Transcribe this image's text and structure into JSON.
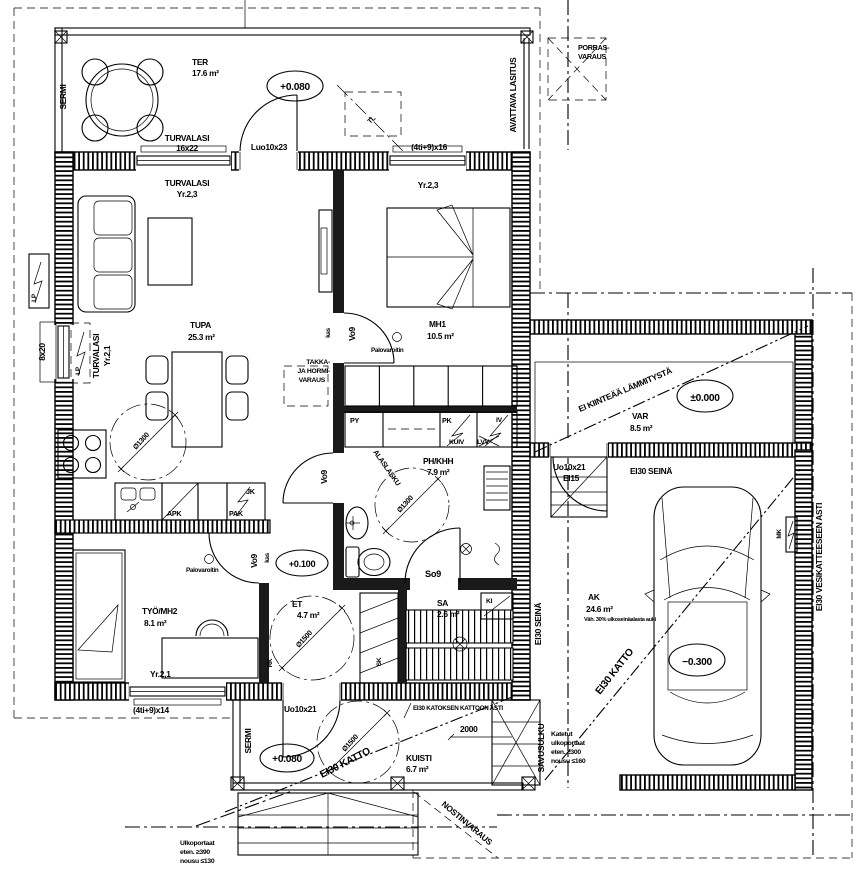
{
  "rooms": {
    "ter": {
      "name": "TER",
      "area": "17.6 m²"
    },
    "tupa": {
      "name": "TUPA",
      "area": "25.3 m²"
    },
    "mh1": {
      "name": "MH1",
      "area": "10.5 m²"
    },
    "ph_khh": {
      "name": "PH/KHH",
      "area": "7.9 m²"
    },
    "tyo_mh2": {
      "name": "TYÖ/MH2",
      "area": "8.1 m²"
    },
    "et": {
      "name": "ET",
      "area": "4.7 m²"
    },
    "sa": {
      "name": "SA",
      "area": "2.6 m²"
    },
    "var": {
      "name": "VAR",
      "area": "8.5 m²"
    },
    "ak": {
      "name": "AK",
      "area": "24.6 m²",
      "note": "Väh. 30% ulkoseinäalasta auki"
    },
    "kuisti": {
      "name": "KUISTI",
      "area": "6.7 m²"
    }
  },
  "levels": {
    "terrace": "+0.080",
    "porch": "+0.080",
    "entry": "+0.100",
    "storage": "±0.000",
    "carport": "−0.300"
  },
  "openings": {
    "turvalasi": "TURVALASI",
    "w16x22": "16x22",
    "luo10x23": "Luo10x23",
    "w4ti9x16": "(4ti+9)x16",
    "yr23": "Yr.2,3",
    "w8x20": "8x20",
    "yr21": "Yr.2,1",
    "w4ti9x14": "(4ti+9)x14",
    "uo10x21": "Uo10x21",
    "ei15": "EI15",
    "vo9": "Vo9",
    "so9": "So9",
    "kas": "kas"
  },
  "annotations": {
    "sermi": "SERMI",
    "avattava": "AVATTAVA LASITUS",
    "porras1": "PORRAS-",
    "porras2": "VARAUS",
    "tl": "TL",
    "palovaroitin": "Palovaroitin",
    "takka1": "TAKKA-",
    "takka2": "JA HORMI-",
    "takka3": "VARAUS",
    "alaslasku": "ALASLASKU",
    "ei_kiintea": "EI KIINTEÄÄ LÄMMITYSTÄ",
    "ei30_seina": "EI30 SEINÄ",
    "ei30_katto": "EI30 KATTO",
    "ei30_vesikate": "EI30 VESIKATTEESEEN ASTI",
    "ei30_katos": "EI30 KATOKSEN KATTOON ASTI",
    "savusulku": "SAVUSULKU",
    "nostinvaraus": "NOSTINVARAUS",
    "mk": "MK",
    "lp": "LP",
    "rk": "RK",
    "sk": "SK",
    "ki": "KI"
  },
  "appliances": {
    "apk": "APK",
    "pak": "PAK",
    "jk": "JK",
    "py": "PY",
    "pk": "PK",
    "kuiv": "KUIV",
    "lvv": "LVV",
    "iv": "IV"
  },
  "stairs": {
    "outdoor": [
      "Ulkoportaat",
      "eten. ≥390",
      "nousu ≤130"
    ],
    "covered": [
      "Katetut",
      "ulkoportaat",
      "eten. ≥300",
      "nousu ≤160"
    ]
  },
  "dimensions": {
    "porch_depth": "2000",
    "turning_circle_small": "Ø1300",
    "turning_circle_large": "Ø1500"
  }
}
